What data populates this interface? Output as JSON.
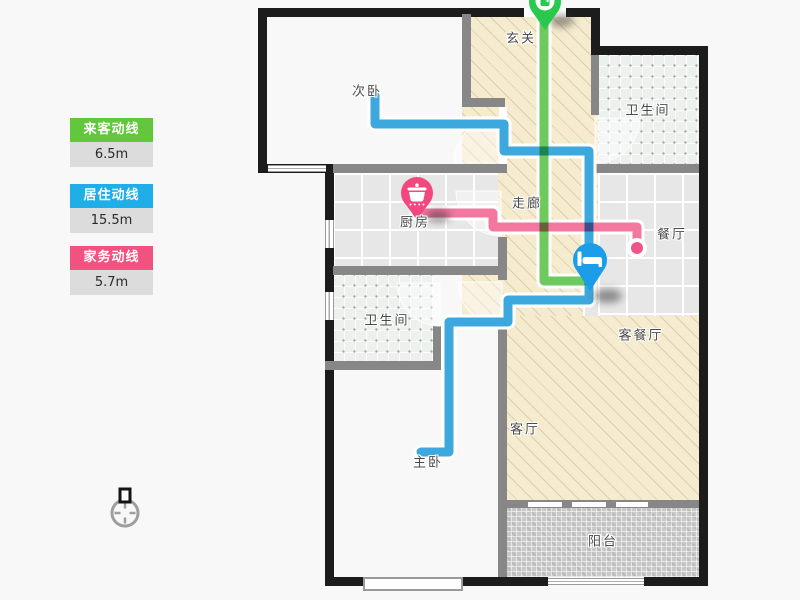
{
  "legend": {
    "items": [
      {
        "label": "来客动线",
        "value": "6.5m",
        "color": "#62C73C"
      },
      {
        "label": "居住动线",
        "value": "15.5m",
        "color": "#1FAEE8"
      },
      {
        "label": "家务动线",
        "value": "5.7m",
        "color": "#F2527F"
      }
    ]
  },
  "rooms": {
    "entrance": "玄关",
    "bedroom2": "次卧",
    "bathroom1": "卫生间",
    "corridor": "走廊",
    "kitchen": "厨房",
    "dining": "餐厅",
    "living_dining": "客餐厅",
    "bathroom2": "卫生间",
    "living": "客厅",
    "master_bedroom": "主卧",
    "balcony": "阳台"
  },
  "markers": {
    "entrance_pin": {
      "icon": "entry-pin-icon",
      "color": "#29C94E"
    },
    "kitchen_pin": {
      "icon": "cooking-pot-pin-icon",
      "color": "#F2487F"
    },
    "bed_pin": {
      "icon": "bed-pin-icon",
      "color": "#1B9DE8"
    }
  },
  "compass": {
    "icon": "north-indicator-icon"
  }
}
